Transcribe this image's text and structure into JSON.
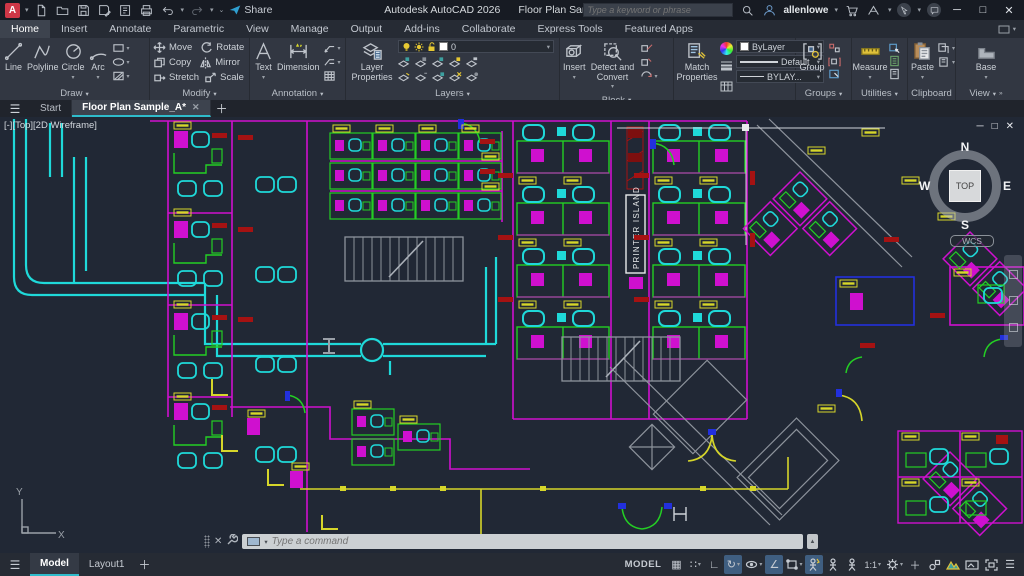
{
  "titlebar": {
    "app_title": "Autodesk AutoCAD 2026",
    "doc_title": "Floor Plan Sample_A.dwg",
    "share": "Share",
    "search_placeholder": "Type a keyword or phrase",
    "user": "allenlowe"
  },
  "ribbon_tabs": [
    {
      "label": "Home"
    },
    {
      "label": "Insert"
    },
    {
      "label": "Annotate"
    },
    {
      "label": "Parametric"
    },
    {
      "label": "View"
    },
    {
      "label": "Manage"
    },
    {
      "label": "Output"
    },
    {
      "label": "Add-ins"
    },
    {
      "label": "Collaborate"
    },
    {
      "label": "Express Tools"
    },
    {
      "label": "Featured Apps"
    }
  ],
  "panels": {
    "draw": {
      "label": "Draw",
      "line": "Line",
      "polyline": "Polyline",
      "circle": "Circle",
      "arc": "Arc"
    },
    "modify": {
      "label": "Modify",
      "move": "Move",
      "copy": "Copy",
      "stretch": "Stretch",
      "rotate": "Rotate",
      "mirror": "Mirror",
      "scale": "Scale"
    },
    "annotation": {
      "label": "Annotation",
      "text": "Text",
      "dimension": "Dimension"
    },
    "layers": {
      "label": "Layers",
      "layer_properties": "Layer Properties",
      "current_layer": "0"
    },
    "block": {
      "label": "Block",
      "insert": "Insert",
      "detect": "Detect and Convert"
    },
    "properties": {
      "label": "Properties",
      "match": "Match Properties",
      "color": "ByLayer",
      "lineweight": "Default",
      "linetype": "BYLAY..."
    },
    "groups": {
      "label": "Groups",
      "group": "Group"
    },
    "utilities": {
      "label": "Utilities",
      "measure": "Measure"
    },
    "clipboard": {
      "label": "Clipboard",
      "paste": "Paste"
    },
    "view": {
      "label": "View",
      "base": "Base"
    }
  },
  "file_tabs": {
    "start": "Start",
    "drawing": "Floor Plan Sample_A*"
  },
  "viewport": {
    "label": "[-][Top][2D Wireframe]",
    "printer_island_label": "PRINTER  ISLAND",
    "viewcube": {
      "n": "N",
      "s": "S",
      "e": "E",
      "w": "W",
      "top": "TOP",
      "wcs": "WCS"
    },
    "ucs": {
      "x": "X",
      "y": "Y"
    }
  },
  "command_line": {
    "placeholder": "Type a command"
  },
  "status_bar": {
    "model_tab": "Model",
    "layout_tab": "Layout1",
    "space": "MODEL",
    "annotation_scale": "1:1"
  },
  "colors": {
    "accent_teal": "#2fbccb",
    "cad_cyan": "#1fd9d9",
    "cad_magenta": "#cf10cf",
    "cad_green": "#24cf24",
    "cad_red": "#a51212",
    "cad_yellow": "#d6d62a",
    "cad_blue": "#2230dd",
    "ribbon_bg": "#323742",
    "drawing_bg": "#212835"
  }
}
